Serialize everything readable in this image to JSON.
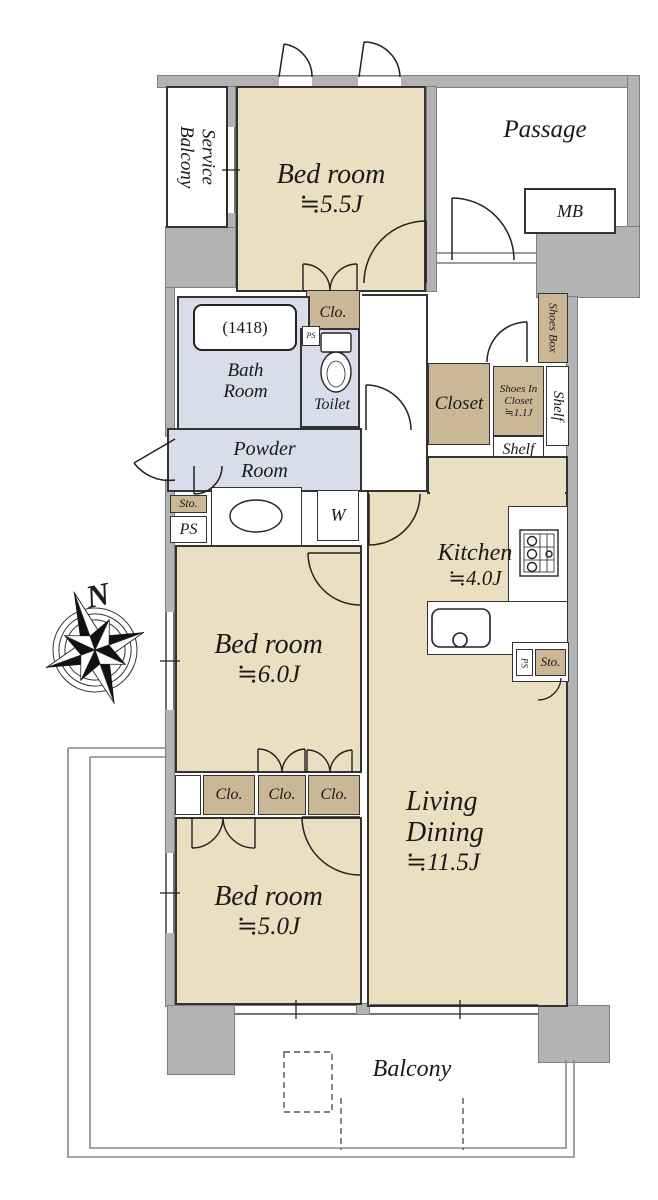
{
  "colors": {
    "room": "#eadfc0",
    "closet": "#c9b795",
    "wet": "#d9dde9",
    "wall": "#b3b3b3"
  },
  "compass": {
    "north": "N"
  },
  "rooms": {
    "service_balcony": {
      "line1": "Service",
      "line2": "Balcony"
    },
    "bedroom_top": {
      "name": "Bed room",
      "size": "≒5.5J"
    },
    "passage": {
      "label": "Passage"
    },
    "meter_box": {
      "label": "MB"
    },
    "closet_top": {
      "label": "Clo."
    },
    "bathroom": {
      "line1": "Bath",
      "line2": "Room",
      "tub_size": "(1418)"
    },
    "ps_toilet": {
      "label": "PS"
    },
    "toilet": {
      "label": "Toilet"
    },
    "powder_room": {
      "line1": "Powder",
      "line2": "Room"
    },
    "storage_left": {
      "label": "Sto."
    },
    "ps_left": {
      "label": "PS"
    },
    "washer": {
      "label": "W"
    },
    "closet_hall": {
      "label": "Closet"
    },
    "shoes_in_closet": {
      "line1": "Shoes In",
      "line2": "Closet",
      "line3": "≒1.1J"
    },
    "shelf_side": {
      "label": "Shelf"
    },
    "shelf_bottom": {
      "label": "Shelf"
    },
    "shoes_box": {
      "label": "Shoes Box"
    },
    "kitchen": {
      "name": "Kitchen",
      "size": "≒4.0J"
    },
    "ps_kitchen": {
      "label": "PS"
    },
    "storage_kitchen": {
      "label": "Sto."
    },
    "bedroom_mid": {
      "name": "Bed room",
      "size": "≒6.0J"
    },
    "closet_row": {
      "a": "Clo.",
      "b": "Clo.",
      "c": "Clo."
    },
    "bedroom_bottom": {
      "name": "Bed room",
      "size": "≒5.0J"
    },
    "living_dining": {
      "line1": "Living",
      "line2": "Dining",
      "size": "≒11.5J"
    },
    "balcony": {
      "label": "Balcony"
    }
  }
}
